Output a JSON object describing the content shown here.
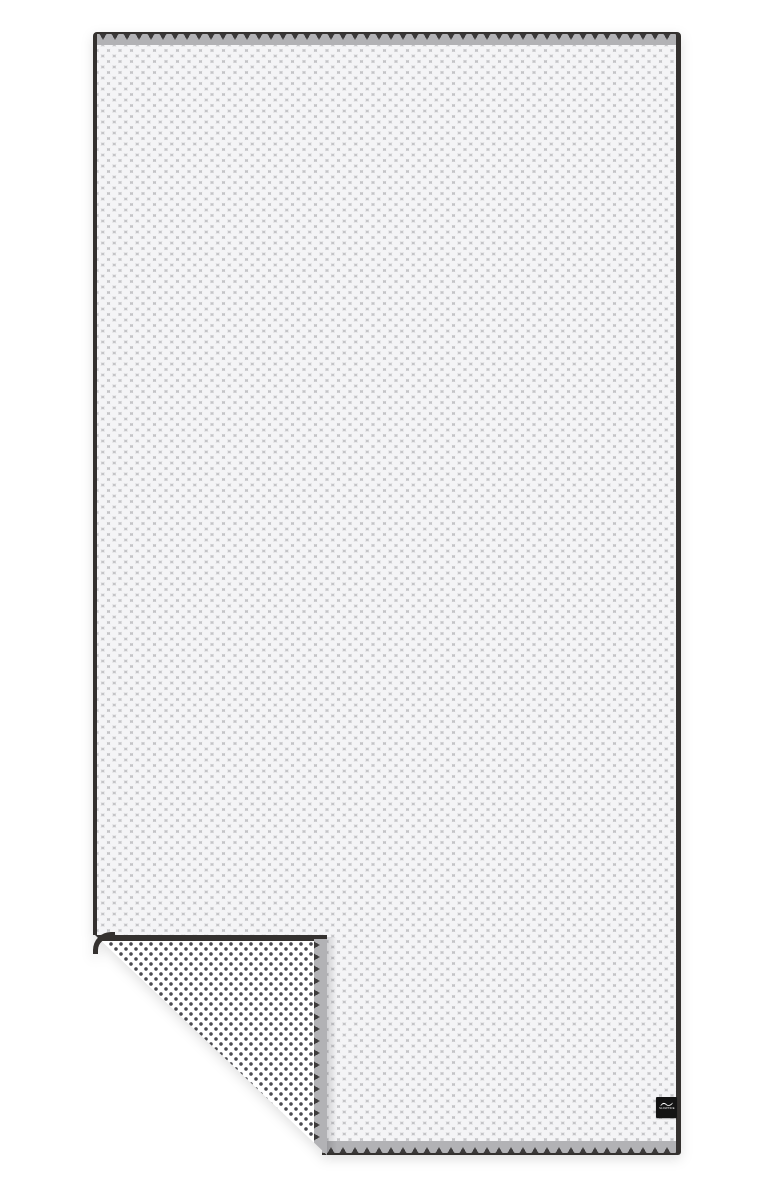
{
  "scene": {
    "kind": "product-photo",
    "subject": "beach towel, front side gray with white dot jacquard, bottom-left corner folded up showing white reverse side with small dark mini dots",
    "background_color": "#ffffff"
  },
  "towel": {
    "front": {
      "pattern": "white-dot-jacquard",
      "base_color": "#8a8a8f",
      "dot_color": "#f4f4f6"
    },
    "trim": {
      "border_color": "#34312f",
      "hem_color": "#b2b2b5",
      "stitch_color": "#3c3a3a",
      "stitch_style": "triangle-zigzag"
    },
    "back": {
      "pattern": "mini-dot",
      "base_color": "#ffffff",
      "dot_color": "#4b4b50"
    },
    "fold": {
      "position": "bottom-left",
      "reveals": "reverse side"
    },
    "tag": {
      "icon": "wave-logo-icon",
      "text": "SLOWTIDE",
      "background": "#141414",
      "text_color": "#ffffff"
    }
  }
}
